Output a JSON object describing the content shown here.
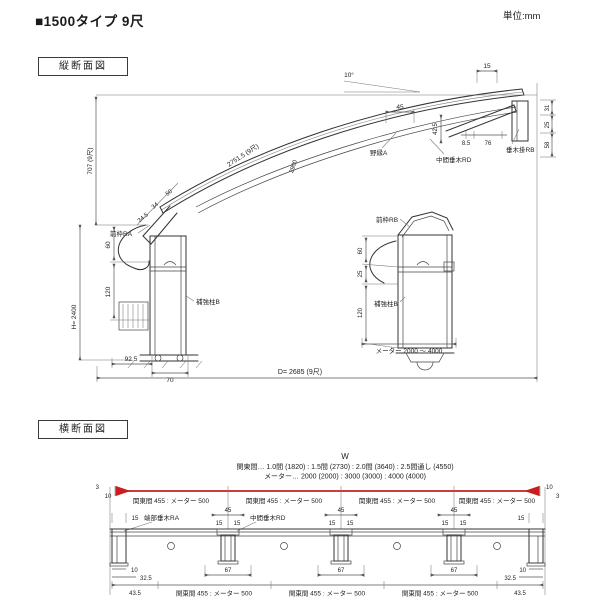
{
  "header": {
    "title": "■1500タイプ 9尺",
    "unit": "単位:mm"
  },
  "colors": {
    "accent_red": "#c81e1e",
    "line": "#3a3a3a"
  },
  "longitudinal": {
    "section_label": "縦断面図",
    "angle_label": "10°",
    "curve_length": "2751.5 (9尺)",
    "curve_note": "2900",
    "labels": {
      "front_frame_ra": "前枠RA",
      "front_frame_rb": "前枠RB",
      "rafter_hook_rb": "垂木掛RB",
      "mid_rafter_rd": "中間垂木RD",
      "furring_a": "野縁A",
      "post_b_left": "補強柱B",
      "post_b_right": "補強柱B"
    },
    "dims": {
      "rise": "707 (9尺)",
      "post_height": "H= 2400",
      "d60": "60",
      "d120": "120",
      "d92_5": "92.5",
      "d70": "70",
      "depth": "D= 2685 (9尺)",
      "meter_range": "メーター 2000 〜 4000",
      "d45": "45",
      "d42_5": "42.5",
      "d34_5": "34.5",
      "d34": "34",
      "d50": "50",
      "d15": "15",
      "d8_5": "8.5",
      "d76": "76",
      "d31": "31",
      "d25": "25",
      "d58": "58",
      "r60": "60",
      "r25": "25",
      "r120": "120"
    }
  },
  "cross": {
    "section_label": "横断面図",
    "w_label": "W",
    "note_kanto": "関東間… 1.0間 (1820) : 1.5間 (2730) : 2.0間 (3640) : 2.5間通し (4550)",
    "note_meter": "メーター… 2000 (2000) : 3000 (3000) : 4000 (4000)",
    "segment_label": "関東間 455 : メーター 500",
    "labels": {
      "end_rafter_ra": "端部垂木RA",
      "mid_rafter_rd": "中間垂木RD"
    },
    "dims": {
      "d3": "3",
      "d10": "10",
      "d15": "15",
      "d45": "45",
      "d67": "67",
      "d32_5": "32.5",
      "d43_5": "43.5"
    }
  }
}
